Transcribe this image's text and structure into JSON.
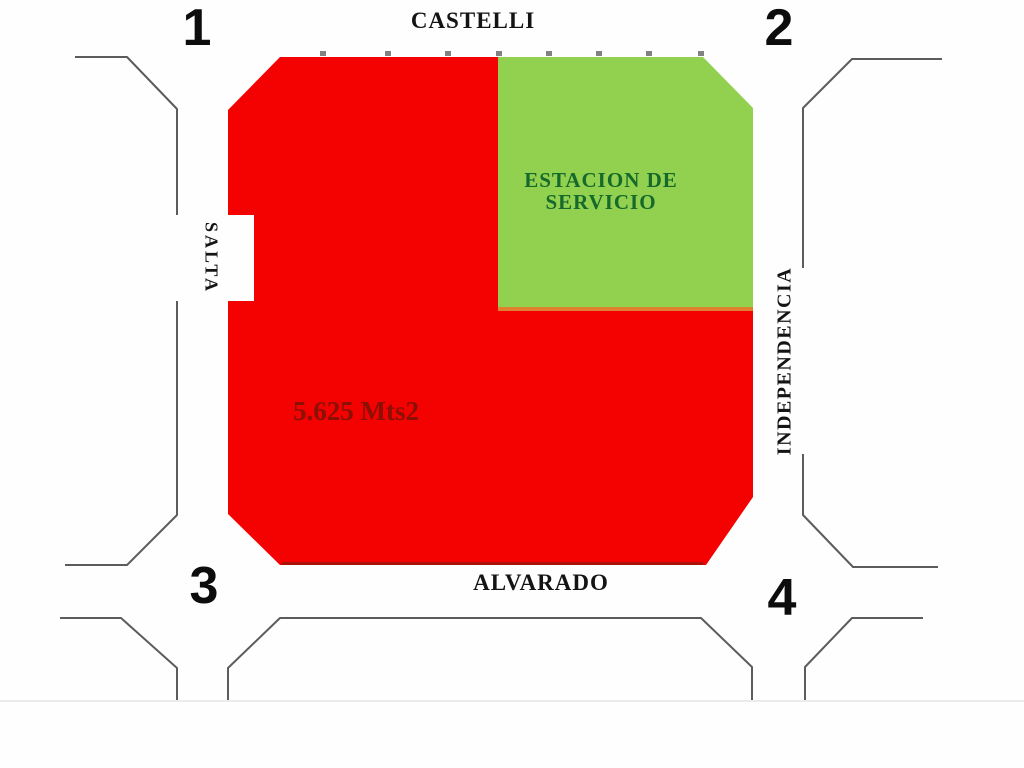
{
  "diagram": {
    "corner_labels": [
      "1",
      "2",
      "3",
      "4"
    ],
    "streets": {
      "top": "CASTELLI",
      "left": "SALTA",
      "right": "INDEPENDENCIA",
      "bottom": "ALVARADO"
    },
    "lot": {
      "area": "5.625 Mts2"
    },
    "station": {
      "line1": "ESTACION DE",
      "line2": "SERVICIO"
    },
    "colors": {
      "lot_fill": "#f40101",
      "lot_area_text": "#8b1004",
      "lot_bottom_edge": "#9c1506",
      "station_fill": "#92d050",
      "station_text": "#15692a",
      "station_divider": "#e0812f",
      "curb_line": "#5c5c5c",
      "label_text": "#141414",
      "background": "#fefefe"
    }
  }
}
